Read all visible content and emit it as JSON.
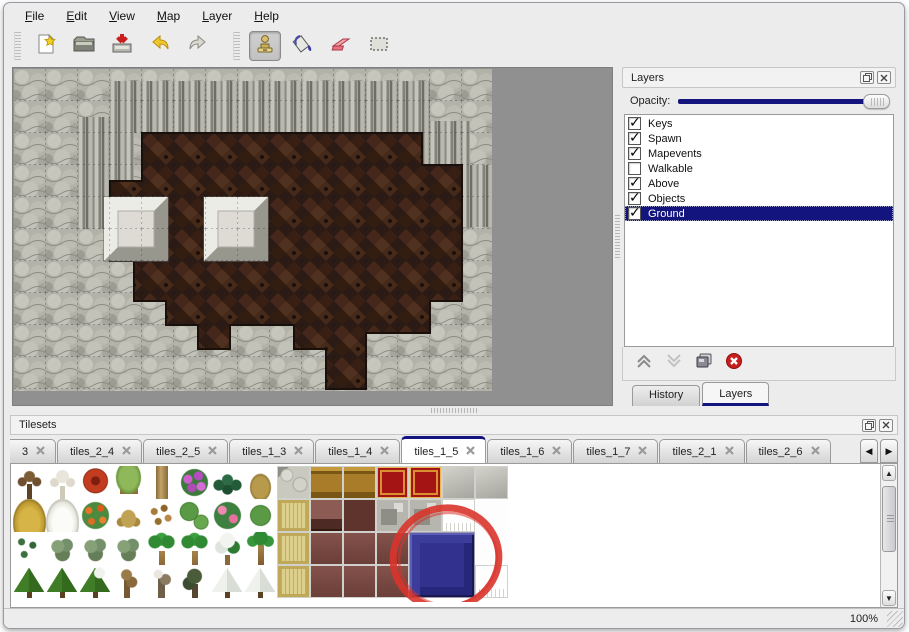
{
  "menu": {
    "items": [
      "File",
      "Edit",
      "View",
      "Map",
      "Layer",
      "Help"
    ]
  },
  "toolbar": {
    "tools": [
      {
        "name": "new",
        "icon": "new-file-icon",
        "group": 1,
        "active": false
      },
      {
        "name": "open",
        "icon": "open-folder-icon",
        "group": 1,
        "active": false
      },
      {
        "name": "save",
        "icon": "save-icon",
        "group": 1,
        "active": false
      },
      {
        "name": "undo",
        "icon": "undo-icon",
        "group": 1,
        "active": false
      },
      {
        "name": "redo",
        "icon": "redo-icon",
        "group": 1,
        "active": false
      },
      {
        "name": "stamp",
        "icon": "stamp-tool-icon",
        "group": 2,
        "active": true
      },
      {
        "name": "fill",
        "icon": "fill-bucket-icon",
        "group": 2,
        "active": false
      },
      {
        "name": "eraser",
        "icon": "eraser-icon",
        "group": 2,
        "active": false
      },
      {
        "name": "select",
        "icon": "select-rect-icon",
        "group": 2,
        "active": false
      }
    ]
  },
  "layers_panel": {
    "title": "Layers",
    "opacity_label": "Opacity:",
    "opacity_percent": 96,
    "layers": [
      {
        "label": "Keys",
        "checked": true,
        "selected": false
      },
      {
        "label": "Spawn",
        "checked": true,
        "selected": false
      },
      {
        "label": "Mapevents",
        "checked": true,
        "selected": false
      },
      {
        "label": "Walkable",
        "checked": false,
        "selected": false
      },
      {
        "label": "Above",
        "checked": true,
        "selected": false
      },
      {
        "label": "Objects",
        "checked": true,
        "selected": false
      },
      {
        "label": "Ground",
        "checked": true,
        "selected": true
      }
    ],
    "action_icons": [
      "move-layer-up-icon",
      "move-layer-down-icon",
      "duplicate-layer-icon",
      "delete-layer-icon"
    ],
    "tabs": [
      {
        "label": "History",
        "active": false
      },
      {
        "label": "Layers",
        "active": true
      }
    ]
  },
  "tilesets_panel": {
    "title": "Tilesets",
    "tabs": [
      {
        "label": "3",
        "active": false,
        "clipped": true
      },
      {
        "label": "tiles_2_4",
        "active": false
      },
      {
        "label": "tiles_2_5",
        "active": false
      },
      {
        "label": "tiles_1_3",
        "active": false
      },
      {
        "label": "tiles_1_4",
        "active": false
      },
      {
        "label": "tiles_1_5",
        "active": true
      },
      {
        "label": "tiles_1_6",
        "active": false
      },
      {
        "label": "tiles_1_7",
        "active": false
      },
      {
        "label": "tiles_2_1",
        "active": false
      },
      {
        "label": "tiles_2_6",
        "active": false
      }
    ],
    "scroll_left_icon": "◀",
    "scroll_right_icon": "▶",
    "tile_grid": [
      [
        "deadtree",
        "whitetree",
        "redbloom",
        "stump",
        "trunk",
        "purpleflowers",
        "fern",
        "dryplant",
        "stonecobble",
        "woodtop",
        "woodtop",
        "redcarpet",
        "redcarpet",
        "graytile",
        "graytile"
      ],
      [
        "haypile",
        "snowpile",
        "orangeflowers",
        "drytuft",
        "leaves",
        "lilypads",
        "pinkflowers",
        "lilypad",
        "tancarpet",
        "maroonsm",
        "maroondk",
        "metal",
        "metal",
        "whitefringe",
        "white"
      ],
      [
        "sprouts",
        "bush",
        "bush",
        "bush",
        "palm",
        "palm",
        "snowtree",
        "palmtall",
        "tancarpet",
        "maroon",
        "maroon",
        "maroon",
        "blue2x2",
        "skip",
        "white"
      ],
      [
        "conifer",
        "conifer",
        "conifersnow",
        "twistedtree",
        "gnarledtree",
        "darktree",
        "snowconifer",
        "snowconifer",
        "tancarpet",
        "maroon",
        "maroon",
        "maroon",
        "skip",
        "skip",
        "whitefringe"
      ]
    ],
    "annotation": {
      "shape": "red-circle",
      "color": "#d9342b"
    }
  },
  "status_bar": {
    "zoom_level": "100%"
  },
  "colors": {
    "selection_navy": "#14147e",
    "slider_fill": "#14147e",
    "annotation_red": "#d9342b",
    "canvas_gray": "#909090"
  }
}
